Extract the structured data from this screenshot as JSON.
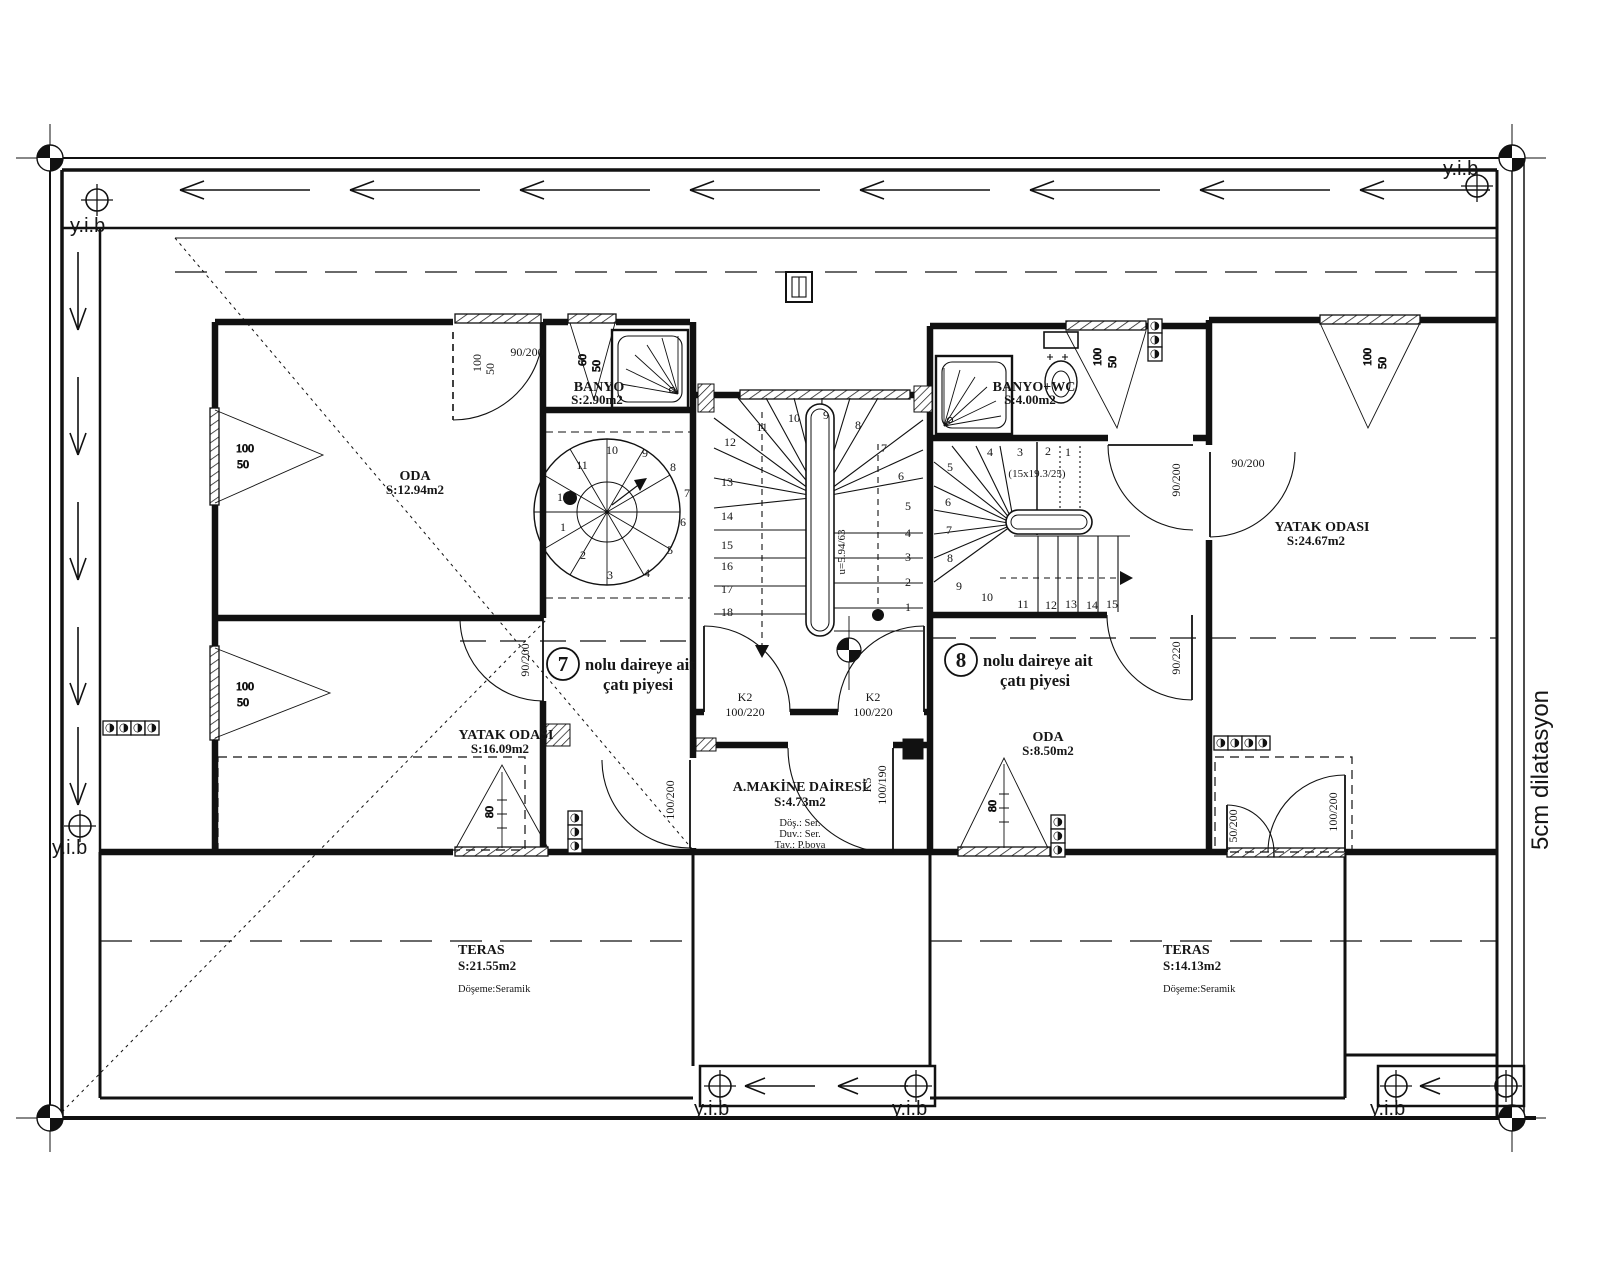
{
  "drawing": {
    "marks": {
      "yib": "y.i.b",
      "dilatasyon": "5cm dilatasyon"
    },
    "apartments": [
      {
        "number": "7",
        "line1": "nolu daireye ait",
        "line2": "çatı piyesi"
      },
      {
        "number": "8",
        "line1": "nolu daireye ait",
        "line2": "çatı piyesi"
      }
    ],
    "rooms": {
      "oda7": {
        "name": "ODA",
        "area": "S:12.94m2"
      },
      "banyo7": {
        "name": "BANYO",
        "area": "S:2.90m2"
      },
      "yatak7": {
        "name": "YATAK ODASI",
        "area": "S:16.09m2"
      },
      "makine": {
        "name": "A.MAKİNE DAİRESİ",
        "area": "S:4.73m2",
        "floor": "Döş.: Ser.",
        "wall": "Duv.: Ser.",
        "ceiling": "Tav.: P.boya"
      },
      "banyo8": {
        "name": "BANYO+WC",
        "area": "S:4.00m2"
      },
      "yatak8": {
        "name": "YATAK ODASI",
        "area": "S:24.67m2"
      },
      "oda8": {
        "name": "ODA",
        "area": "S:8.50m2"
      },
      "teras7": {
        "name": "TERAS",
        "area": "S:21.55m2",
        "floor": "Döşeme:Seramik"
      },
      "teras8": {
        "name": "TERAS",
        "area": "S:14.13m2",
        "floor": "Döşeme:Seramik"
      }
    },
    "doors": {
      "d90200": "90/200",
      "d90220": "90/220",
      "d100200": "100/200",
      "d50200": "50/200",
      "k2": "K2",
      "k2_size": "100/220",
      "k5": "K5",
      "k5_size": "100/190"
    },
    "windows": {
      "w100": "100",
      "w50": "50",
      "w60": "60",
      "w80": "80"
    },
    "stairs": {
      "main": {
        "note": "u=5.94/63",
        "numbers": [
          "1",
          "2",
          "3",
          "4",
          "5",
          "6",
          "7",
          "8",
          "9",
          "10",
          "11",
          "12",
          "13",
          "14",
          "15",
          "16",
          "17",
          "18"
        ]
      },
      "side": {
        "note": "(15x19.3/25)",
        "numbers": [
          "1",
          "2",
          "3",
          "4",
          "5",
          "6",
          "7",
          "8",
          "9",
          "10",
          "11",
          "12",
          "13",
          "14",
          "15"
        ]
      },
      "spiral": {
        "numbers": [
          "1",
          "2",
          "3",
          "4",
          "5",
          "6",
          "7",
          "8",
          "9",
          "10",
          "11",
          "12"
        ]
      }
    }
  }
}
